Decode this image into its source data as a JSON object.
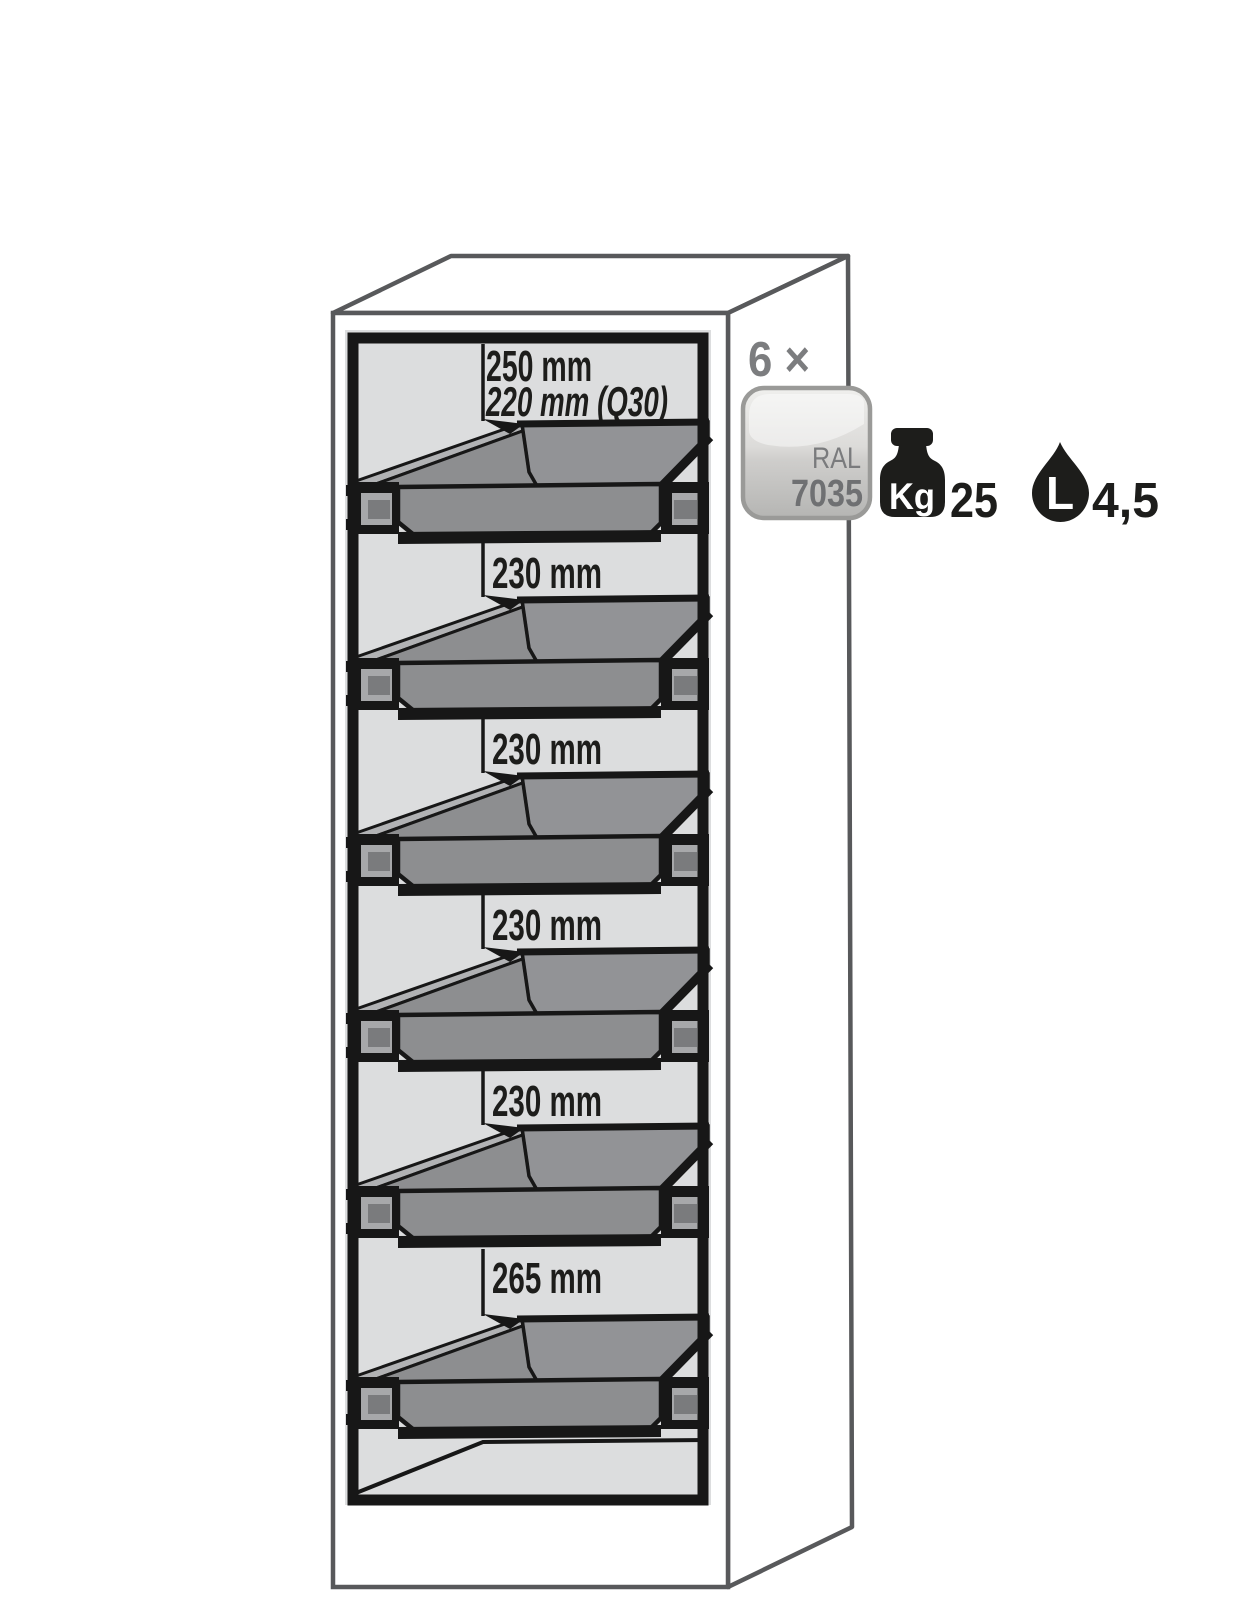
{
  "cabinet": {
    "description": "safety cabinet cutaway with six pull-out trays",
    "compartments": [
      {
        "height_label": "250 mm",
        "alt_height_label": "220 mm (Q30)"
      },
      {
        "height_label": "230 mm"
      },
      {
        "height_label": "230 mm"
      },
      {
        "height_label": "230 mm"
      },
      {
        "height_label": "230 mm"
      },
      {
        "height_label": "265 mm"
      }
    ]
  },
  "callouts": {
    "quantity": "6 ×",
    "color_badge": {
      "line1": "RAL",
      "line2": "7035",
      "color_hex": "#d7d7d5"
    },
    "load_capacity": {
      "icon": "weight-icon",
      "unit_label": "Kg",
      "value": "25"
    },
    "volume": {
      "icon": "drop-icon",
      "unit_label": "L",
      "value": "4,5"
    }
  },
  "colors": {
    "outline_gray": "#58595b",
    "frame_black": "#171717",
    "interior_gray": "#dcddde",
    "tray_gray": "#8d8e90",
    "rail_band_gray": "#b1b2b4",
    "icon_black": "#1d1d1b",
    "annotation_gray": "#7c7d7f"
  }
}
